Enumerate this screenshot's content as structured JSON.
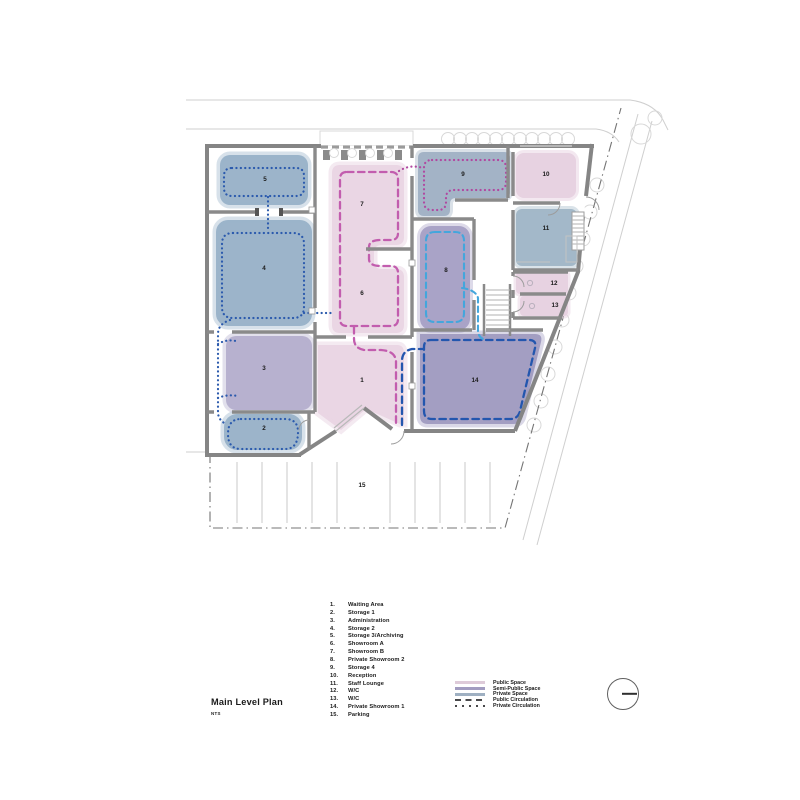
{
  "title_block": {
    "title": "Main Level Plan",
    "scale_note": "NTS"
  },
  "rooms": [
    {
      "num": "1.",
      "label": "1",
      "name": "Waiting Area"
    },
    {
      "num": "2.",
      "label": "2",
      "name": "Storage 1"
    },
    {
      "num": "3.",
      "label": "3",
      "name": "Administration"
    },
    {
      "num": "4.",
      "label": "4",
      "name": "Storage 2"
    },
    {
      "num": "5.",
      "label": "5",
      "name": "Storage 3/Archiving"
    },
    {
      "num": "6.",
      "label": "6",
      "name": "Showroom A"
    },
    {
      "num": "7.",
      "label": "7",
      "name": "Showroom B"
    },
    {
      "num": "8.",
      "label": "8",
      "name": "Private Showroom 2"
    },
    {
      "num": "9.",
      "label": "9",
      "name": "Storage 4"
    },
    {
      "num": "10.",
      "label": "10",
      "name": "Reception"
    },
    {
      "num": "11.",
      "label": "11",
      "name": "Staff Lounge"
    },
    {
      "num": "12.",
      "label": "12",
      "name": "W/C"
    },
    {
      "num": "13.",
      "label": "13",
      "name": "W/C"
    },
    {
      "num": "14.",
      "label": "14",
      "name": "Private Showroom 1"
    },
    {
      "num": "15.",
      "label": "15",
      "name": "Parking"
    }
  ],
  "legend": {
    "items": [
      {
        "label": "Public Space",
        "type": "swatch",
        "color": "#decbd9"
      },
      {
        "label": "Semi-Public Space",
        "type": "swatch",
        "color": "#a29cc0"
      },
      {
        "label": "Private Space",
        "type": "swatch",
        "color": "#9fb0c2"
      },
      {
        "label": "Public Circulation",
        "type": "dashed-line",
        "color": "#48484a"
      },
      {
        "label": "Private Circulation",
        "type": "dotted-line",
        "color": "#48484a"
      }
    ]
  },
  "plan_colors": {
    "public_space_fill": "#ead6e4",
    "semi_public_space_fill": "#aba5c8",
    "private_space_fill": "#9cb4ca",
    "public_circulation_path": "#c25dae",
    "private_circulation_path": "#2b5aad",
    "secondary_circulation_path": "#44a6dc",
    "wall": "#858585"
  }
}
